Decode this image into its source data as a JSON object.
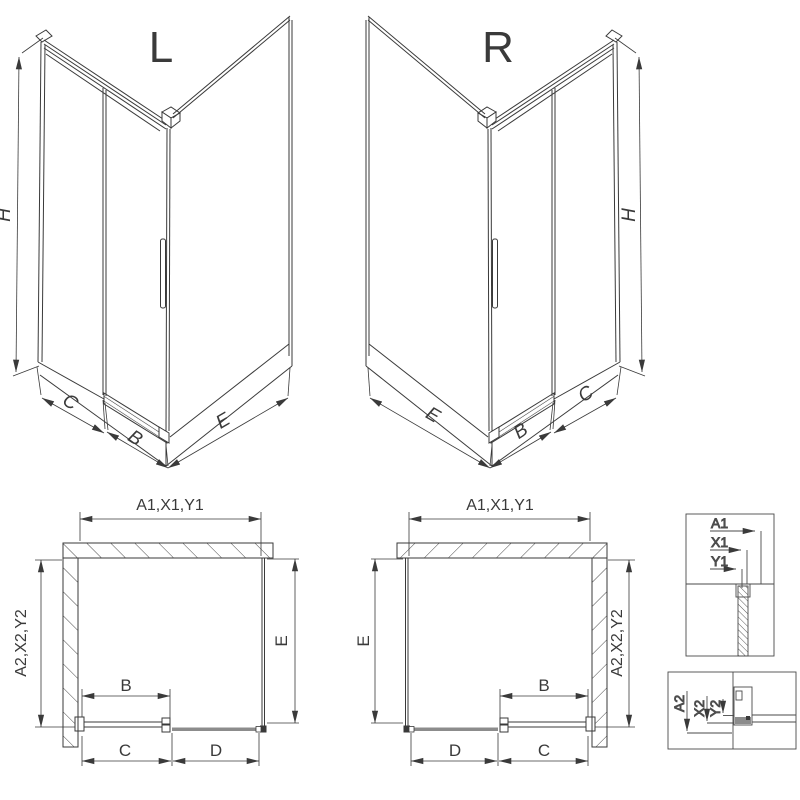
{
  "labels": {
    "variant_left": "L",
    "variant_right": "R",
    "height": "H",
    "side_panel": "C",
    "door": "B",
    "return_panel": "E",
    "fixed_segment": "D",
    "dim_top_group": "A1,X1,Y1",
    "dim_side_group": "A2,X2,Y2",
    "detail_a1": "A1",
    "detail_x1": "X1",
    "detail_y1": "Y1",
    "detail_a2": "A2",
    "detail_x2": "X2",
    "detail_y2": "Y2"
  },
  "colors": {
    "line": "#3a3a3a",
    "panel_gray": "#8c8c8c",
    "background": "#ffffff"
  }
}
